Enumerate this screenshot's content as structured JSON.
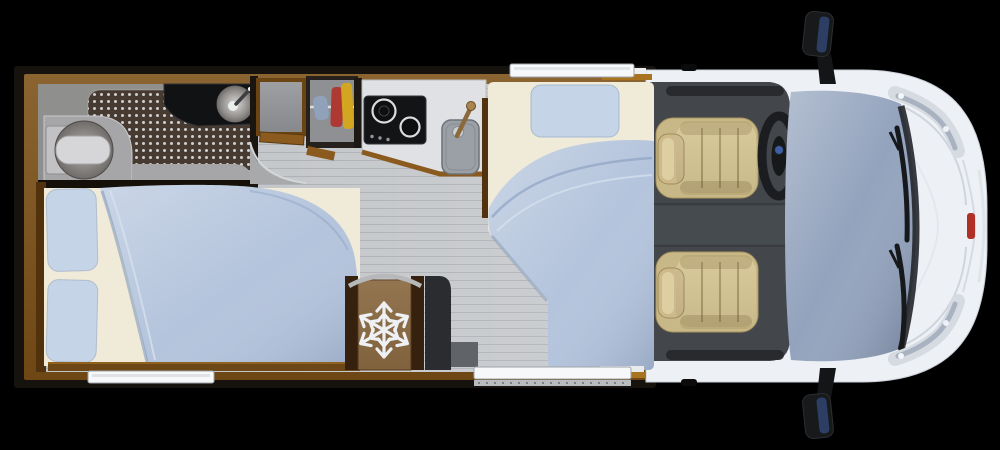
{
  "floorplan": {
    "type": "motorhome-top-view",
    "areas": {
      "bathroom": {
        "components": [
          "toilet",
          "shower-floor",
          "vanity-counter",
          "round-basin",
          "basin-faucet"
        ]
      },
      "wardrobe": {
        "components": [
          "open-cabinet",
          "clothes-closet",
          "clothes-rod",
          "garment-blue",
          "garment-red",
          "garment-yellow"
        ]
      },
      "kitchen": {
        "components": [
          "worktop",
          "two-burner-cooktop",
          "kitchen-sink",
          "wooden-faucet"
        ]
      },
      "galley": {
        "components": [
          "fridge-freezer",
          "entry-step"
        ]
      },
      "sleeping": {
        "components": [
          "rear-double-bed",
          "pillows",
          "duvet",
          "single-bed",
          "single-pillow",
          "single-duvet"
        ]
      },
      "cab": {
        "components": [
          "cab-floor",
          "passenger-seat",
          "driver-seat",
          "steering-wheel",
          "windshield",
          "wipers",
          "headlights",
          "side-mirrors",
          "front-badge"
        ]
      },
      "openings": {
        "components": [
          "top-window",
          "rear-left-window",
          "entry-door-window"
        ]
      }
    },
    "icons": {
      "snowflake-icon": "six-arm snowflake on fridge door",
      "steering-wheel-icon": "dark oval wheel with blue hub badge",
      "faucet-icon": "diagonal tap over round basin",
      "mirror-icon": "black side mirror with dark blue glass"
    },
    "colors": {
      "background": "#000000",
      "module_wall": "#16120d",
      "wood_frame": "#7c5016",
      "wood_dark": "#35210d",
      "floor": "#c0c3c6",
      "bathroom_floor": "#8f8f8e",
      "shower_mat": "#473a31",
      "counter_dark": "#111214",
      "kitchen_counter": "#dfe1e4",
      "mattress": "#f0ead9",
      "duvet": "#b4c4dc",
      "pillow": "#c6d4e7",
      "fridge": "#8a6a42",
      "snowflake": "#eef0f3",
      "panel_dark": "#2a2c2f",
      "cab_floor": "#43474c",
      "seat": "#c9b887",
      "seat_cushion": "#d6c694",
      "body_white": "#edf0f5",
      "glass": "#93a3bd",
      "wiper": "#16181b",
      "headlight": "#d6dbe2",
      "badge_red": "#b03028",
      "mirror_glass": "#2c3e63",
      "window_white": "#f6f8f9"
    }
  }
}
